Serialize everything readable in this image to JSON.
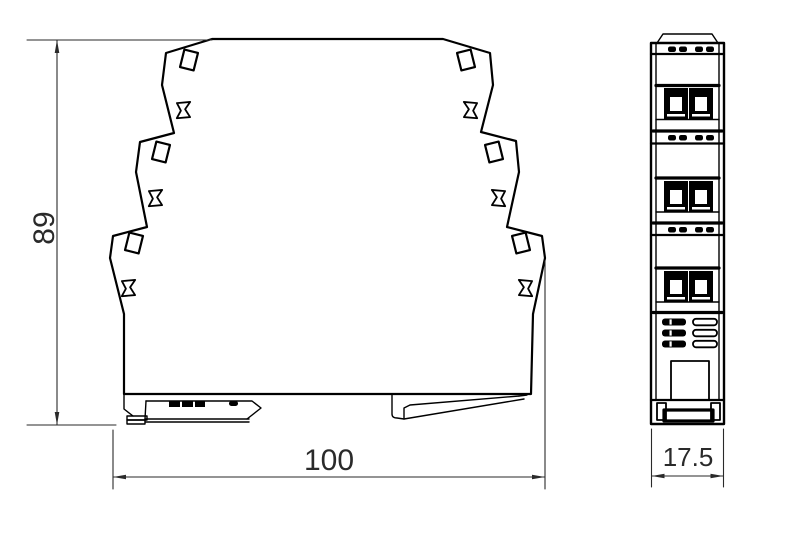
{
  "drawing": {
    "kind": "din-rail-module-dimension-drawing",
    "views": {
      "side": {
        "name": "side-profile-view",
        "height_dimension": {
          "value": "89"
        },
        "width_dimension": {
          "value": "100"
        }
      },
      "front": {
        "name": "front-face-view",
        "width_dimension": {
          "value": "17.5"
        }
      }
    }
  },
  "colors": {
    "background": "#ffffff",
    "line": "#000000",
    "dimension": "#2a2a2a"
  }
}
